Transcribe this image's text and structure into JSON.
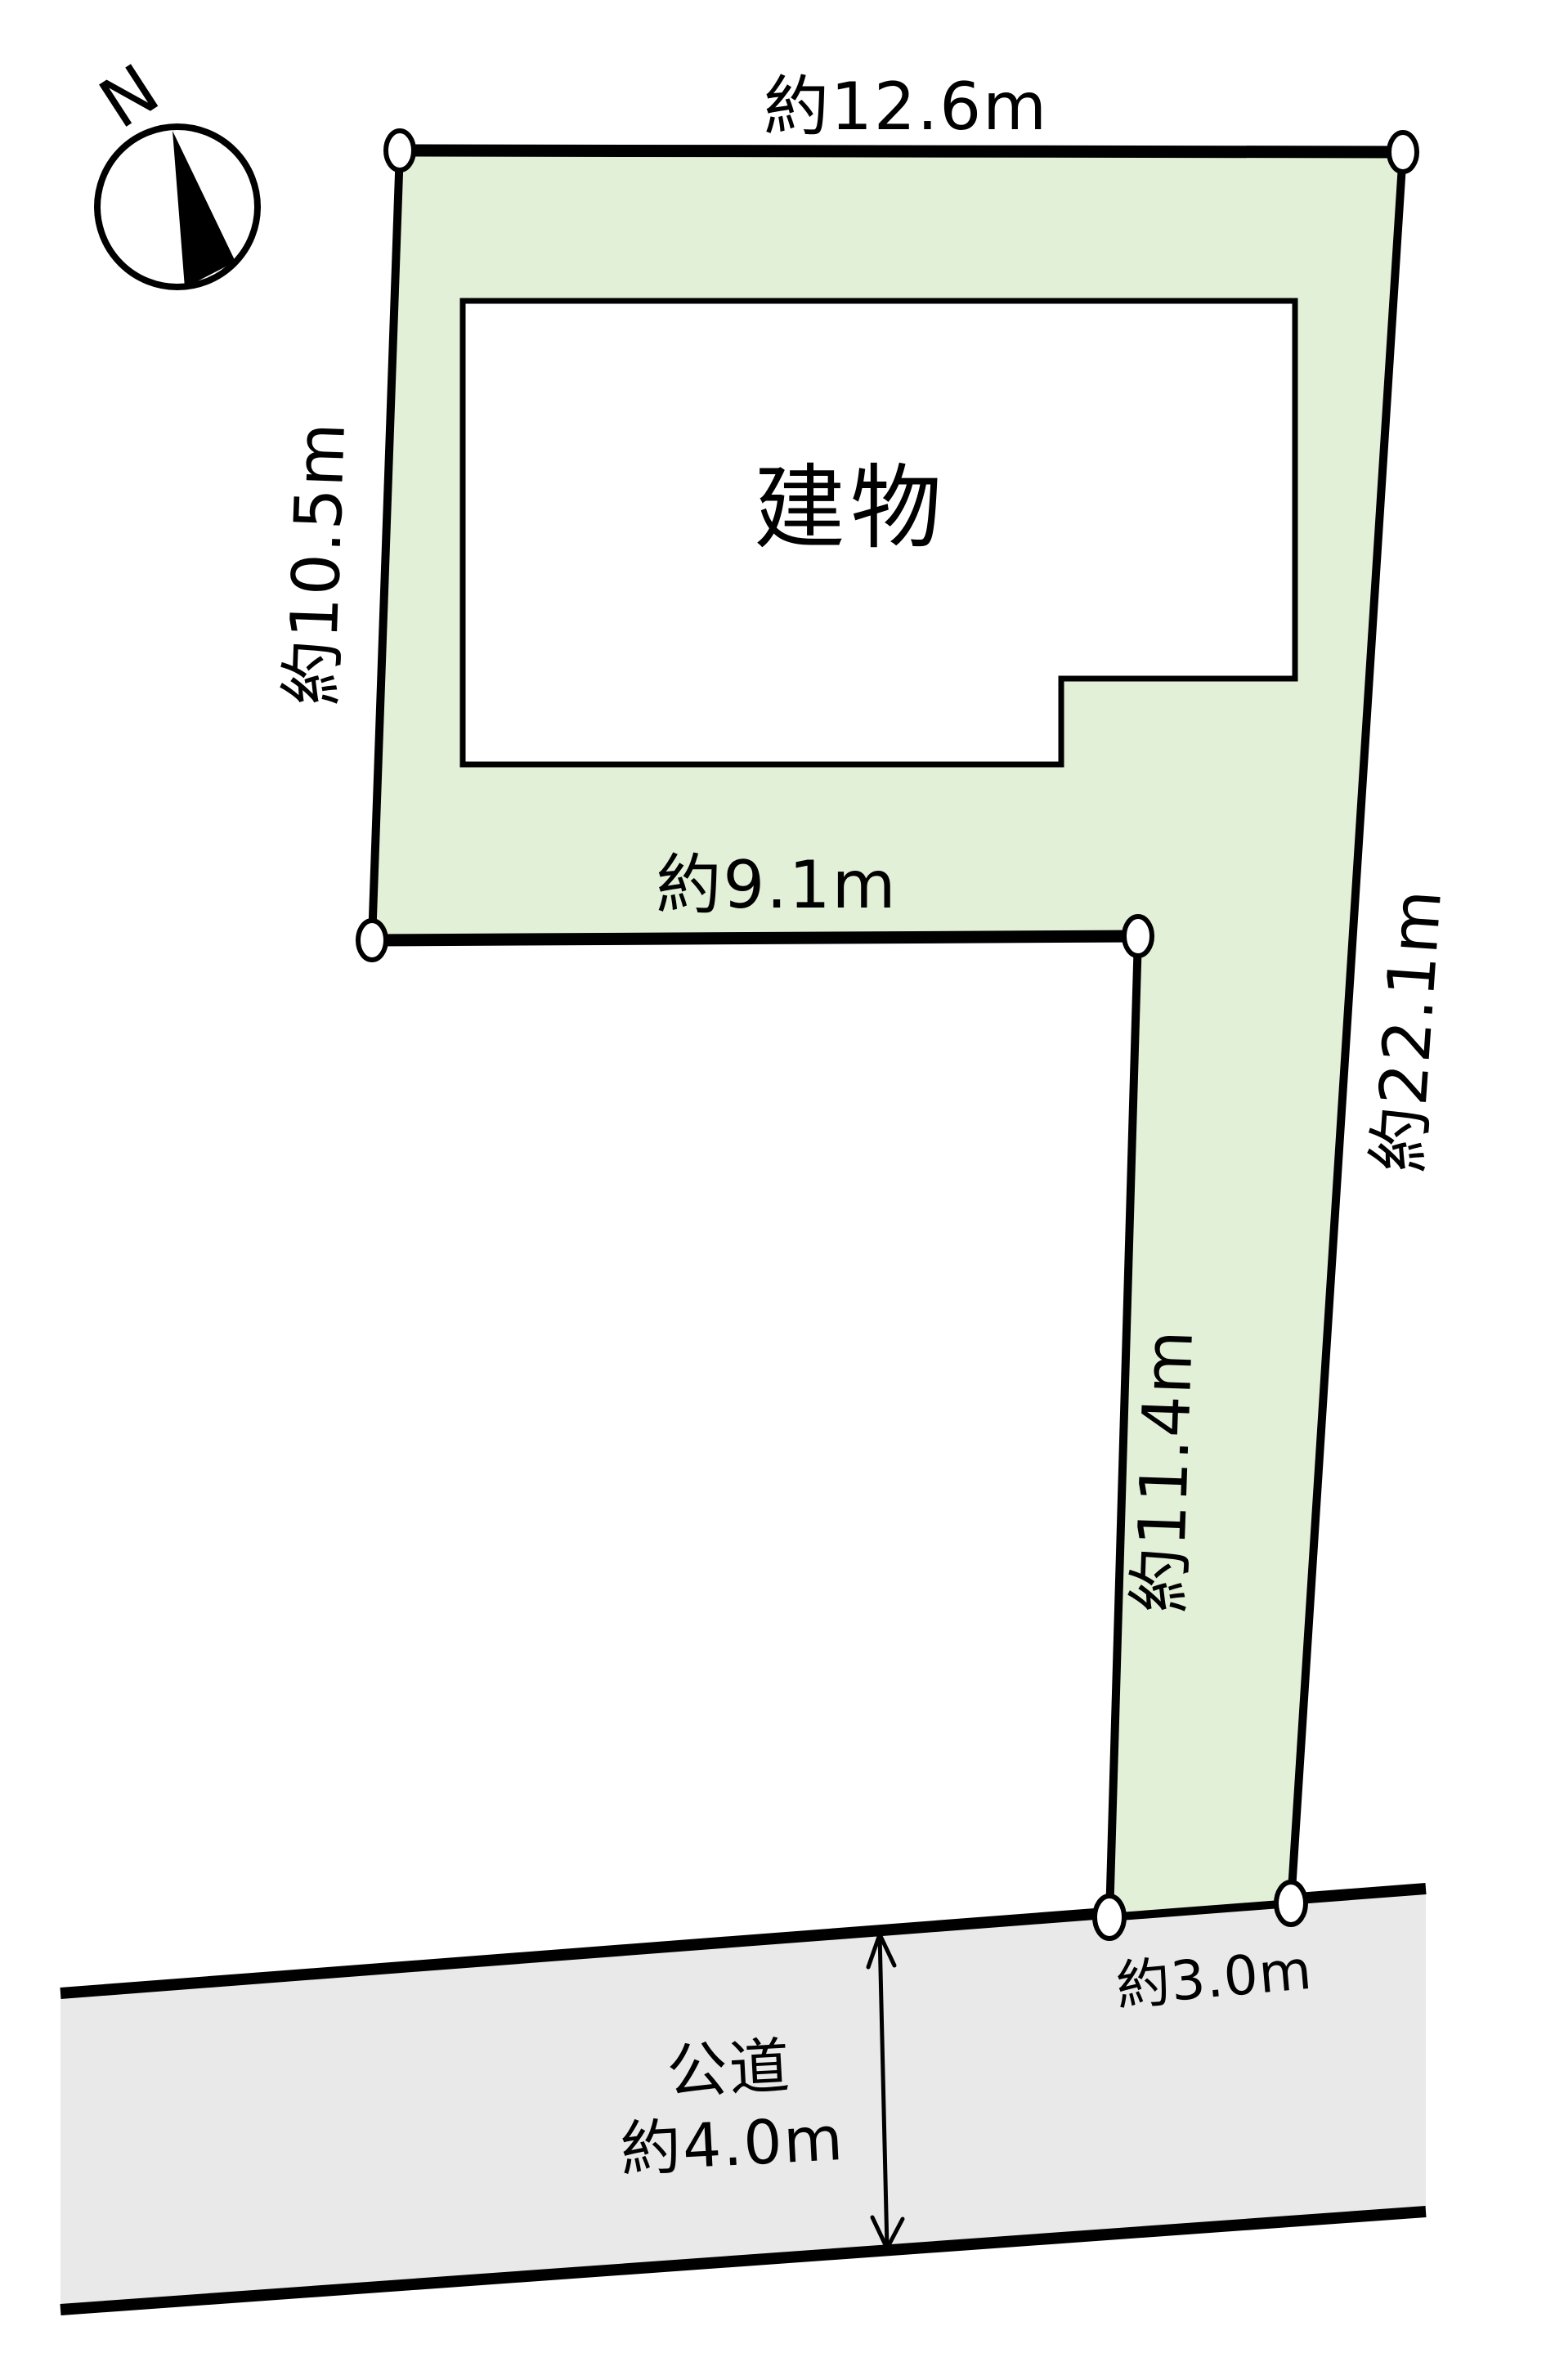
{
  "diagram": {
    "compass": {
      "north_label": "N"
    },
    "lot": {
      "fill_color": "#e3f0d8",
      "dimensions": {
        "top_edge": "約12.6m",
        "left_edge": "約10.5m",
        "inner_bottom_edge": "約9.1m",
        "right_edge": "約22.1m",
        "flag_left_edge": "約11.4m",
        "road_frontage": "約3.0m"
      }
    },
    "building": {
      "label": "建物"
    },
    "road": {
      "fill_color": "#e9e9e9",
      "type_label": "公道",
      "width_label": "約4.0m"
    },
    "line_color": "#000000",
    "background_color": "#ffffff"
  }
}
